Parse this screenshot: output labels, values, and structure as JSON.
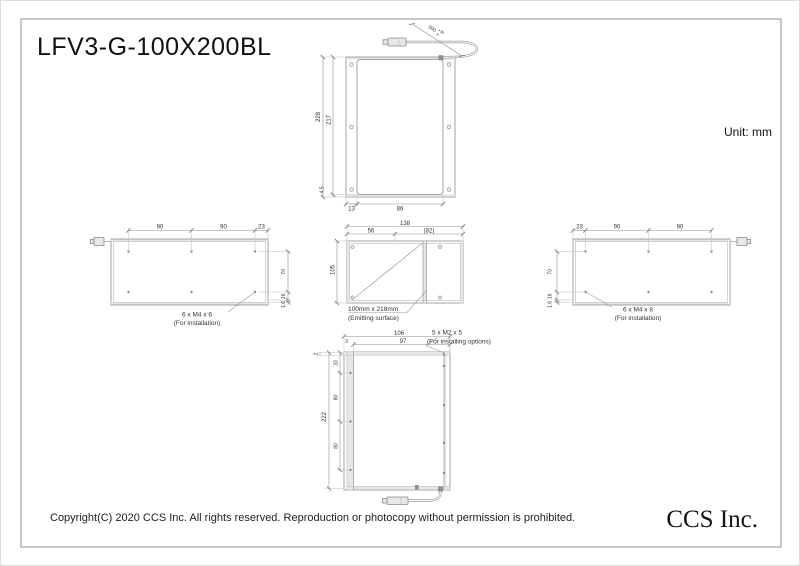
{
  "page": {
    "title": "LFV3-G-100X200BL",
    "unit_label": "Unit: mm",
    "copyright": "Copyright(C) 2020 CCS Inc. All rights reserved. Reproduction or photocopy without permission is prohibited.",
    "logo": "CCS Inc."
  },
  "front_view": {
    "cable_length": "300",
    "cable_tol_plus": "+30",
    "cable_tol_minus": "0",
    "height_outer": "228",
    "height_inner": "217",
    "bottom_margin": "4.5",
    "width_left": "13",
    "width_window": "86"
  },
  "left_side_view": {
    "top_dims": [
      "90",
      "90",
      "23"
    ],
    "side_dims": [
      "70",
      "16",
      "1.6"
    ],
    "note_line1": "6 x M4 x 6",
    "note_line2": "(For installation)"
  },
  "top_view": {
    "width_total": "138",
    "width_left": "56",
    "width_right": "(82)",
    "depth": "105",
    "note_line1": "100mm x 218mm",
    "note_line2": "(Emitting surface)"
  },
  "right_side_view": {
    "top_dims": [
      "23",
      "90",
      "90"
    ],
    "side_dims": [
      "70",
      "16",
      "1.6"
    ],
    "note_line1": "6 x M4 x 8",
    "note_line2": "(For installation)"
  },
  "bottom_view": {
    "width_outer": "106",
    "width_inner": "97",
    "offset_side": "3",
    "offset_corner": "2",
    "height_total": "222",
    "pitch_dims": [
      "33",
      "80",
      "80"
    ],
    "note_line1": "5 x M2 x 5",
    "note_line2": "(For installing options)"
  },
  "colors": {
    "line": "#9a9a9a",
    "dimension": "#8f8f8f",
    "text": "#333333",
    "title_text": "#111111"
  }
}
